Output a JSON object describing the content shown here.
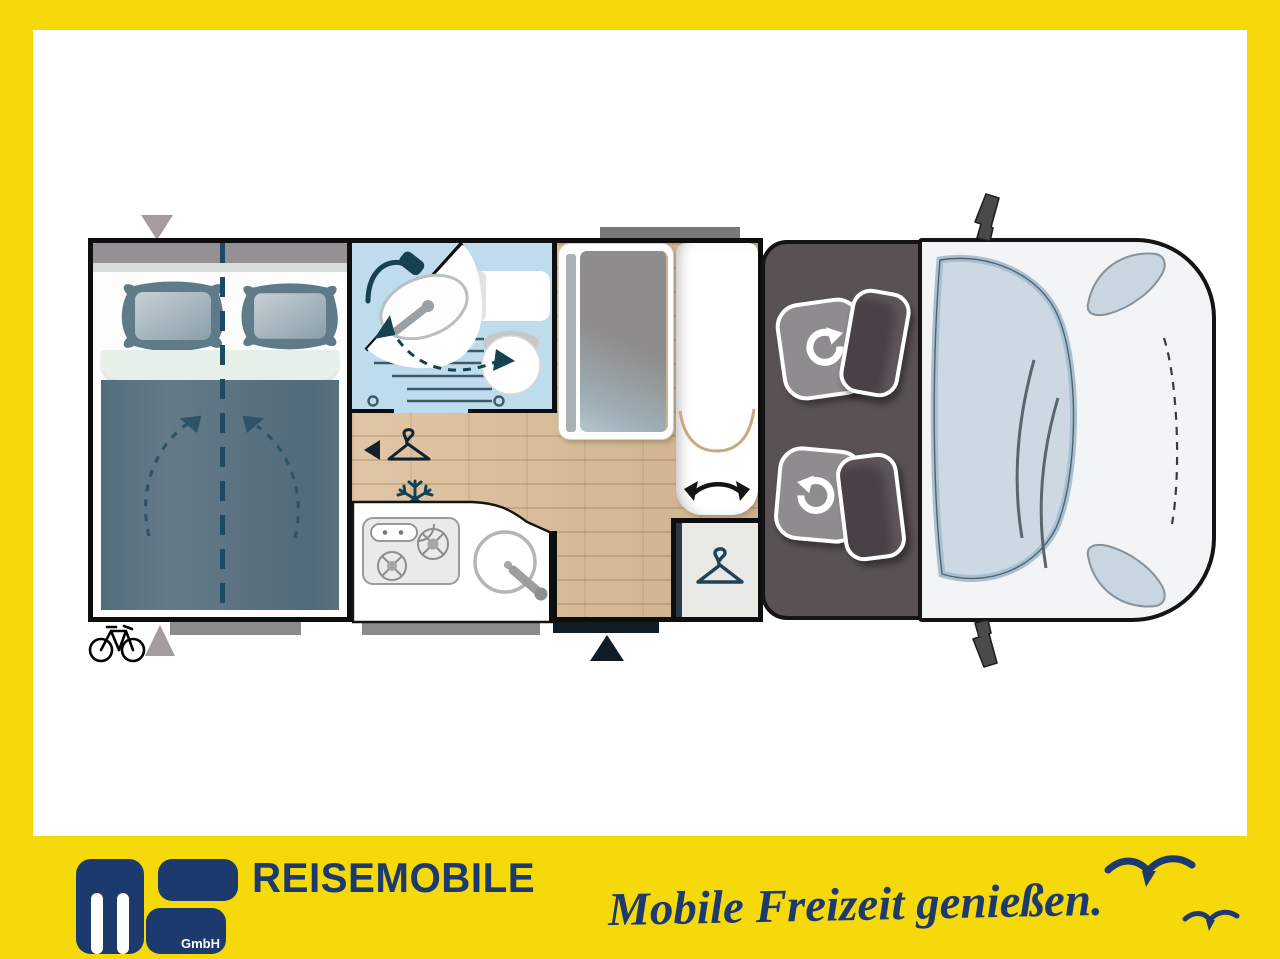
{
  "branding": {
    "logo": {
      "text": "ms",
      "suffix": "GmbH"
    },
    "wordmark": "REISEMOBILE",
    "tagline": "Mobile Freizeit genießen.",
    "colors": {
      "band_yellow": "#f6d90a",
      "navy": "#1c3a6e"
    }
  },
  "floorplan": {
    "areas": [
      {
        "name": "rear-double-bed"
      },
      {
        "name": "washroom-with-swivel-basin"
      },
      {
        "name": "kitchen-block"
      },
      {
        "name": "dinette-table"
      },
      {
        "name": "swivel-lounge-seat"
      },
      {
        "name": "wardrobe"
      },
      {
        "name": "cab-with-two-swivel-seats"
      },
      {
        "name": "vehicle-front"
      }
    ],
    "icons": [
      {
        "name": "shower-icon"
      },
      {
        "name": "toilet"
      },
      {
        "name": "washbasin"
      },
      {
        "name": "snowflake-icon",
        "glyph": "❄"
      },
      {
        "name": "hanger-icon",
        "glyph": "🦺"
      },
      {
        "name": "wardrobe-hanger-icon"
      },
      {
        "name": "bicycle-icon",
        "glyph": "🚲"
      },
      {
        "name": "entry-door-marker",
        "glyph": "▲"
      },
      {
        "name": "rear-access-marker",
        "glyph": "▲"
      },
      {
        "name": "bed-lengthwise-split-line"
      },
      {
        "name": "seat-swivel-arrow",
        "glyph": "↻"
      },
      {
        "name": "bench-swivel-arrow"
      },
      {
        "name": "gull-icon"
      }
    ],
    "colors": {
      "bathroom_blue": "#bedcec",
      "wood_floor": "#d9ba93",
      "cab_floor": "#5a5154",
      "duvet_slate": "#5c7482",
      "body_white": "#f2f4f5",
      "windshield_blue": "#ccd9e2"
    }
  }
}
